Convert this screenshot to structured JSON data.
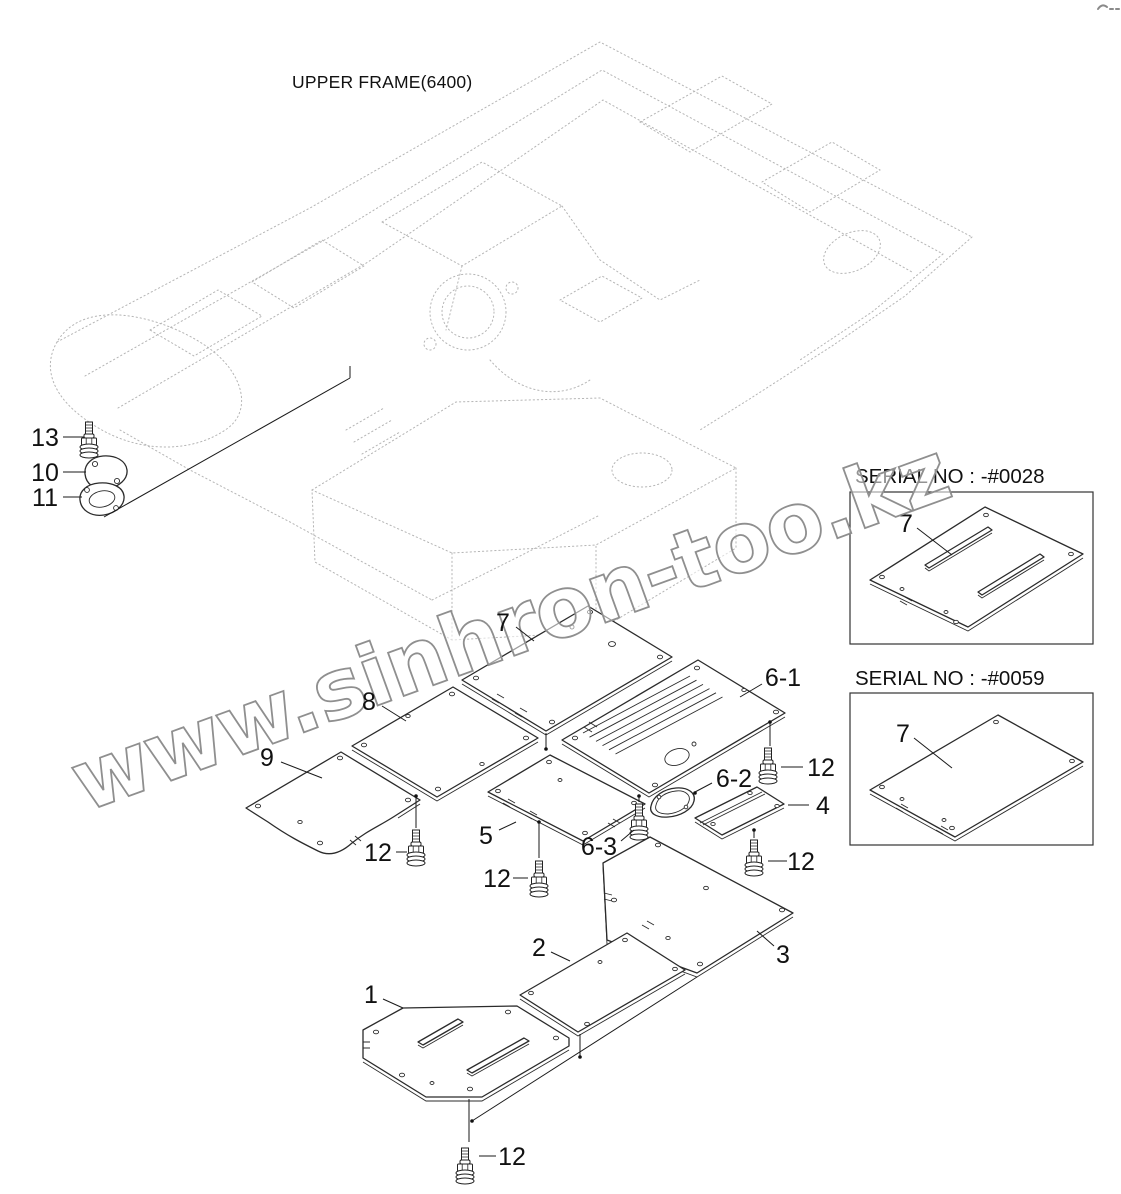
{
  "title": "UPPER FRAME(6400)",
  "watermark": "www.sinhron-too.kz",
  "labels": {
    "p1": "1",
    "p2": "2",
    "p3": "3",
    "p4": "4",
    "p5": "5",
    "p6_1": "6-1",
    "p6_2": "6-2",
    "p6_3": "6-3",
    "p7": "7",
    "p8": "8",
    "p9": "9",
    "p10": "10",
    "p11": "11",
    "p12": "12",
    "p13": "13"
  },
  "serial_boxes": [
    {
      "label": "SERIAL NO : -#0028",
      "part": "7"
    },
    {
      "label": "SERIAL NO : -#0059",
      "part": "7"
    }
  ],
  "colors": {
    "line": "#2b2b2b",
    "wireframe": "#b5b5b5",
    "watermark_stroke": "#8f8f8f"
  }
}
